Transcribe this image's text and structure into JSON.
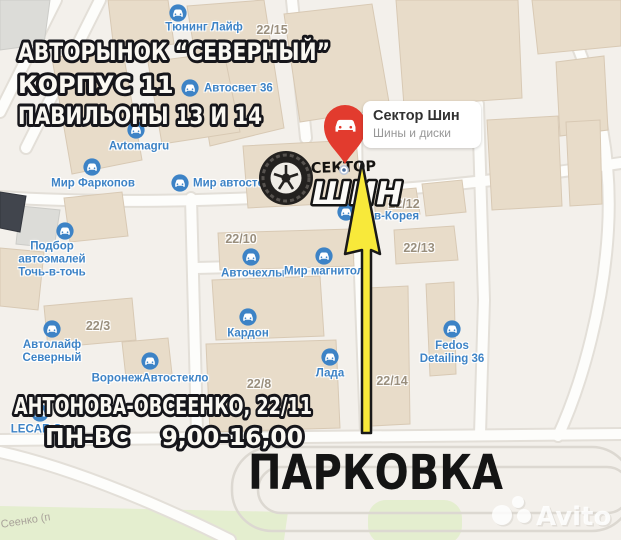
{
  "overlay": {
    "top_lines": [
      "АВТОРЫНОК “СЕВЕРНЫЙ”",
      "КОРПУС 11",
      "ПАВИЛЬОНЫ 13 И 14"
    ],
    "address_line1": "АНТОНОВА-ОВСЕЕНКО, 22/11",
    "hours_line": "ПН-ВС    9,00-16,00",
    "parking": "ПАРКОВКА"
  },
  "pin": {
    "title": "Сектор Шин",
    "subtitle": "Шины и диски"
  },
  "logo": {
    "top": "СЕКТОР",
    "bottom": "ШИН"
  },
  "watermark": {
    "brand": "Avito"
  },
  "street_label": "Сеенко (п",
  "colors": {
    "poi_blue": "#3d83c6",
    "addr_gray": "#9a8f7d",
    "pin_red": "#e23b2e",
    "arrow_yellow": "#f8e93a",
    "building_tan": "#e8dcc9",
    "green_area": "#e4eecf",
    "outline_dark": "#16161b",
    "sticker_white": "#faf8f2"
  },
  "pois": [
    {
      "lines": [
        "Тюнинг Лайф"
      ],
      "icon": {
        "x": 178,
        "y": 13
      },
      "text": {
        "x": 204,
        "y": 28
      },
      "anchor": "center"
    },
    {
      "lines": [
        "Автосвет 36"
      ],
      "icon": {
        "x": 190,
        "y": 88
      },
      "text": {
        "x": 204,
        "y": 89
      },
      "anchor": "left"
    },
    {
      "lines": [
        "Avtomagru"
      ],
      "icon": {
        "x": 136,
        "y": 130
      },
      "text": {
        "x": 139,
        "y": 147
      },
      "anchor": "center"
    },
    {
      "lines": [
        "Мир Фаркопов"
      ],
      "icon": {
        "x": 92,
        "y": 167
      },
      "text": {
        "x": 93,
        "y": 184
      },
      "anchor": "center"
    },
    {
      "lines": [
        "Мир автостекла"
      ],
      "icon": {
        "x": 180,
        "y": 183
      },
      "text": {
        "x": 193,
        "y": 184
      },
      "anchor": "left"
    },
    {
      "lines": [
        "Подбор",
        "автоэмалей",
        "Точь-в-точь"
      ],
      "icon": {
        "x": 65,
        "y": 231
      },
      "text": {
        "x": 52,
        "y": 260
      },
      "anchor": "center"
    },
    {
      "lines": [
        "Авточехлы"
      ],
      "icon": {
        "x": 251,
        "y": 257
      },
      "text": {
        "x": 253,
        "y": 274
      },
      "anchor": "center"
    },
    {
      "lines": [
        "Мир магнитол"
      ],
      "icon": {
        "x": 324,
        "y": 256
      },
      "text": {
        "x": 324,
        "y": 272
      },
      "anchor": "center"
    },
    {
      "lines": [
        "Кардон"
      ],
      "icon": {
        "x": 248,
        "y": 317
      },
      "text": {
        "x": 248,
        "y": 334
      },
      "anchor": "center"
    },
    {
      "lines": [
        "Лада"
      ],
      "icon": {
        "x": 330,
        "y": 357
      },
      "text": {
        "x": 330,
        "y": 374
      },
      "anchor": "center"
    },
    {
      "lines": [
        "Автолайф",
        "Северный"
      ],
      "icon": {
        "x": 52,
        "y": 329
      },
      "text": {
        "x": 52,
        "y": 352
      },
      "anchor": "center"
    },
    {
      "lines": [
        "ВоронежАвтостекло"
      ],
      "icon": {
        "x": 150,
        "y": 361
      },
      "text": {
        "x": 150,
        "y": 379
      },
      "anchor": "center"
    },
    {
      "lines": [
        "в-Корея"
      ],
      "icon": {
        "x": 346,
        "y": 212
      },
      "text": {
        "x": 374,
        "y": 217
      },
      "anchor": "left"
    },
    {
      "lines": [
        "Fedos",
        "Detailing 36"
      ],
      "icon": {
        "x": 452,
        "y": 329
      },
      "text": {
        "x": 452,
        "y": 353
      },
      "anchor": "center"
    },
    {
      "lines": [
        "LECAR S"
      ],
      "icon": {
        "x": 40,
        "y": 413
      },
      "text": {
        "x": 36,
        "y": 430
      },
      "anchor": "center"
    }
  ],
  "addresses": [
    {
      "label": "22/15",
      "x": 272,
      "y": 30
    },
    {
      "label": "22/10",
      "x": 241,
      "y": 239
    },
    {
      "label": "22/12",
      "x": 404,
      "y": 204
    },
    {
      "label": "22/13",
      "x": 419,
      "y": 248
    },
    {
      "label": "22/3",
      "x": 98,
      "y": 326
    },
    {
      "label": "22/8",
      "x": 259,
      "y": 384
    },
    {
      "label": "22/14",
      "x": 392,
      "y": 381
    }
  ]
}
